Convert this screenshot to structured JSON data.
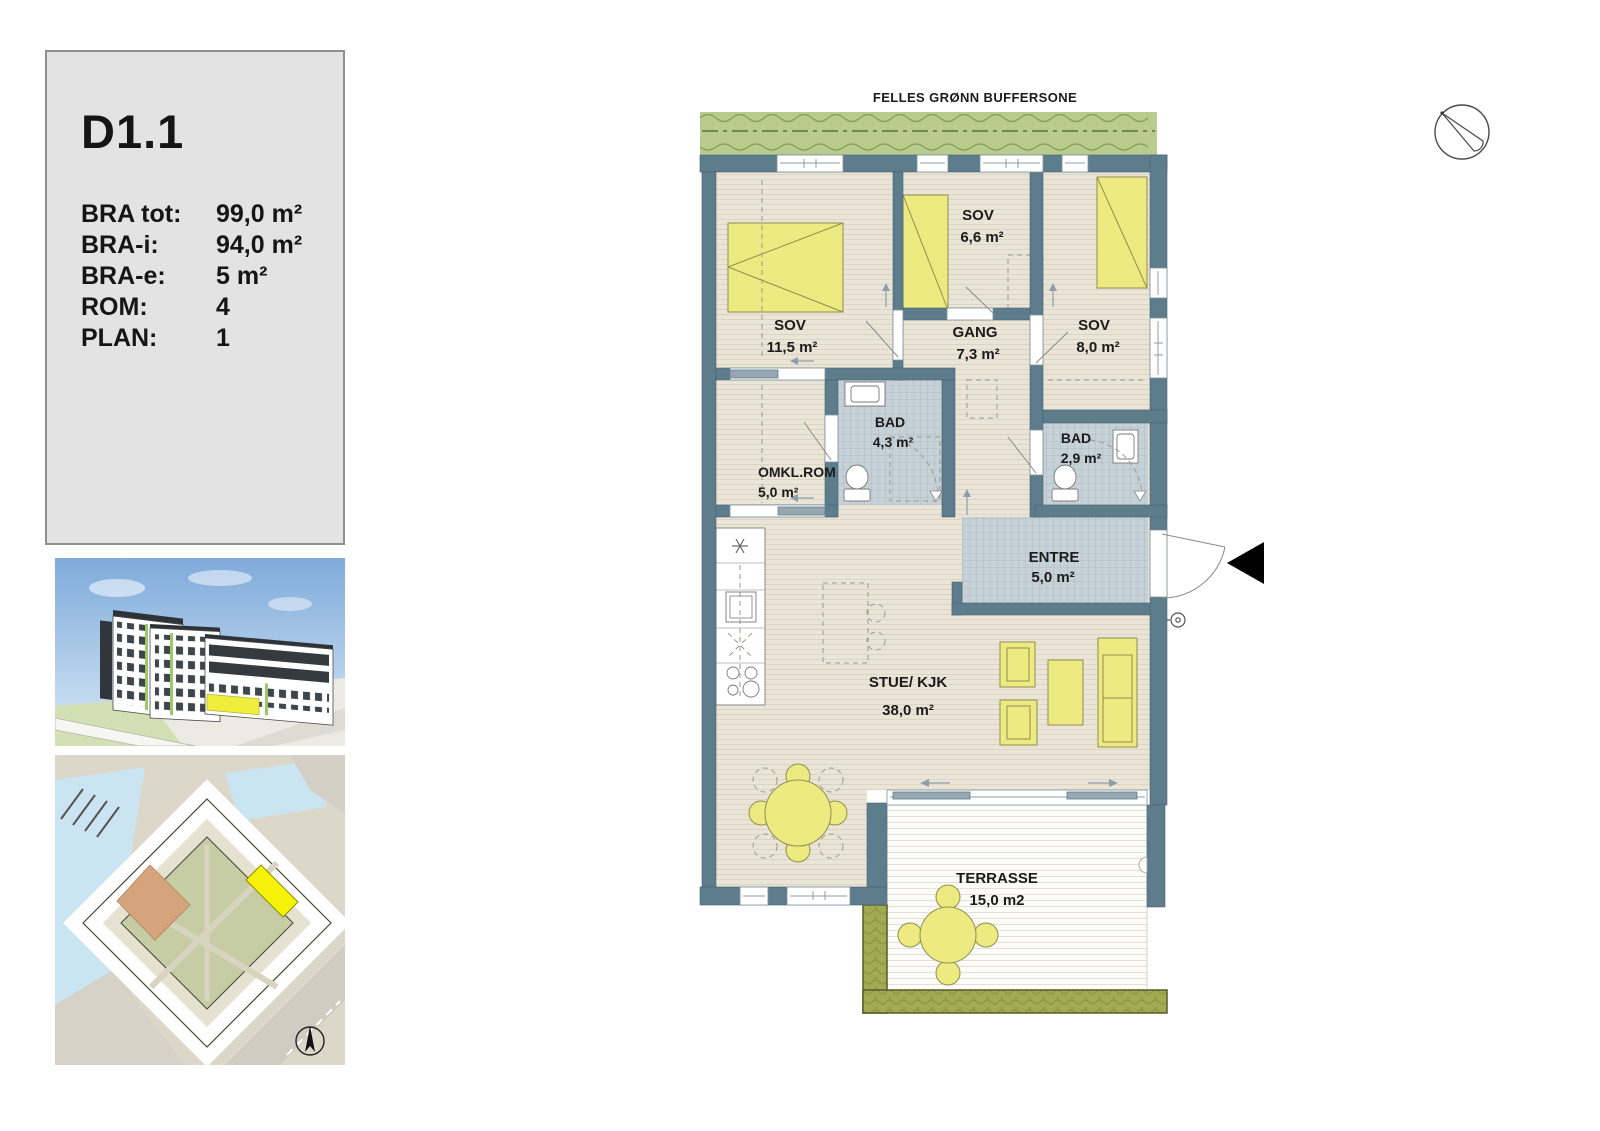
{
  "sidebar": {
    "unit_id": "D1.1",
    "rows": [
      {
        "label": "BRA tot:",
        "value": "99,0 m²"
      },
      {
        "label": "BRA-i:",
        "value": "94,0 m²"
      },
      {
        "label": "BRA-e:",
        "value": "5 m²"
      },
      {
        "label": "ROM:",
        "value": "4"
      },
      {
        "label": "PLAN:",
        "value": "1"
      }
    ]
  },
  "floor_plan": {
    "buffer_zone_label": "FELLES GRØNN BUFFERSONE",
    "rooms": {
      "sov1": {
        "name": "SOV",
        "area": "11,5 m²"
      },
      "sov2": {
        "name": "SOV",
        "area": "6,6 m²"
      },
      "gang": {
        "name": "GANG",
        "area": "7,3 m²"
      },
      "sov3": {
        "name": "SOV",
        "area": "8,0 m²"
      },
      "omkl": {
        "name": "OMKL.ROM",
        "area": "5,0 m²"
      },
      "bad1": {
        "name": "BAD",
        "area": "4,3 m²"
      },
      "bad2": {
        "name": "BAD",
        "area": "2,9 m²"
      },
      "entre": {
        "name": "ENTRE",
        "area": "5,0 m²"
      },
      "stue": {
        "name": "STUE/ KJK",
        "area": "38,0 m²"
      },
      "terrasse": {
        "name": "TERRASSE",
        "area": "15,0 m2"
      }
    }
  },
  "colors": {
    "wall_slate": "#5d7d8d",
    "wood_floor": "#ebe5d8",
    "tile_floor": "#c7d2d8",
    "furniture_yellow": "#edea82",
    "buffer_green": "#b9cb8e",
    "planter_olive": "#a3aa52",
    "unit_highlight_yellow": "#f7f209",
    "panel_gray": "#e3e3e3"
  }
}
